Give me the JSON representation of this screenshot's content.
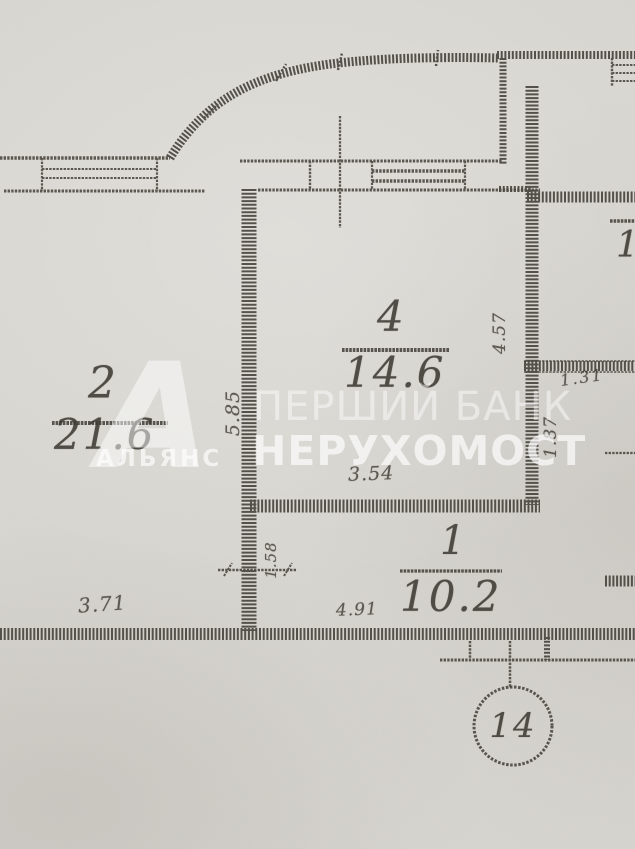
{
  "plan": {
    "unit_number": "14",
    "rooms": [
      {
        "number": "2",
        "area": "21.6"
      },
      {
        "number": "4",
        "area": "14.6"
      },
      {
        "number": "1",
        "area": "10.2"
      }
    ],
    "partial_room_label": "1",
    "dimensions": [
      {
        "value": "5.85",
        "orientation": "vertical"
      },
      {
        "value": "3.71",
        "orientation": "horizontal"
      },
      {
        "value": "3.54",
        "orientation": "horizontal"
      },
      {
        "value": "4.57",
        "orientation": "vertical"
      },
      {
        "value": "4.91",
        "orientation": "horizontal"
      },
      {
        "value": "1.31",
        "orientation": "horizontal"
      },
      {
        "value": "1.87",
        "orientation": "vertical"
      },
      {
        "value": "1.58",
        "orientation": "vertical"
      }
    ]
  },
  "watermark": {
    "line1": "ПЕРШИЙ БАНК",
    "line2": "НЕРУХОМОСТ",
    "logo_letter": "А",
    "logo_text": "АЛЬЯНС"
  },
  "colors": {
    "paper": "#d8d6d0",
    "ink": "#46433c",
    "watermark": "#ffffff"
  }
}
